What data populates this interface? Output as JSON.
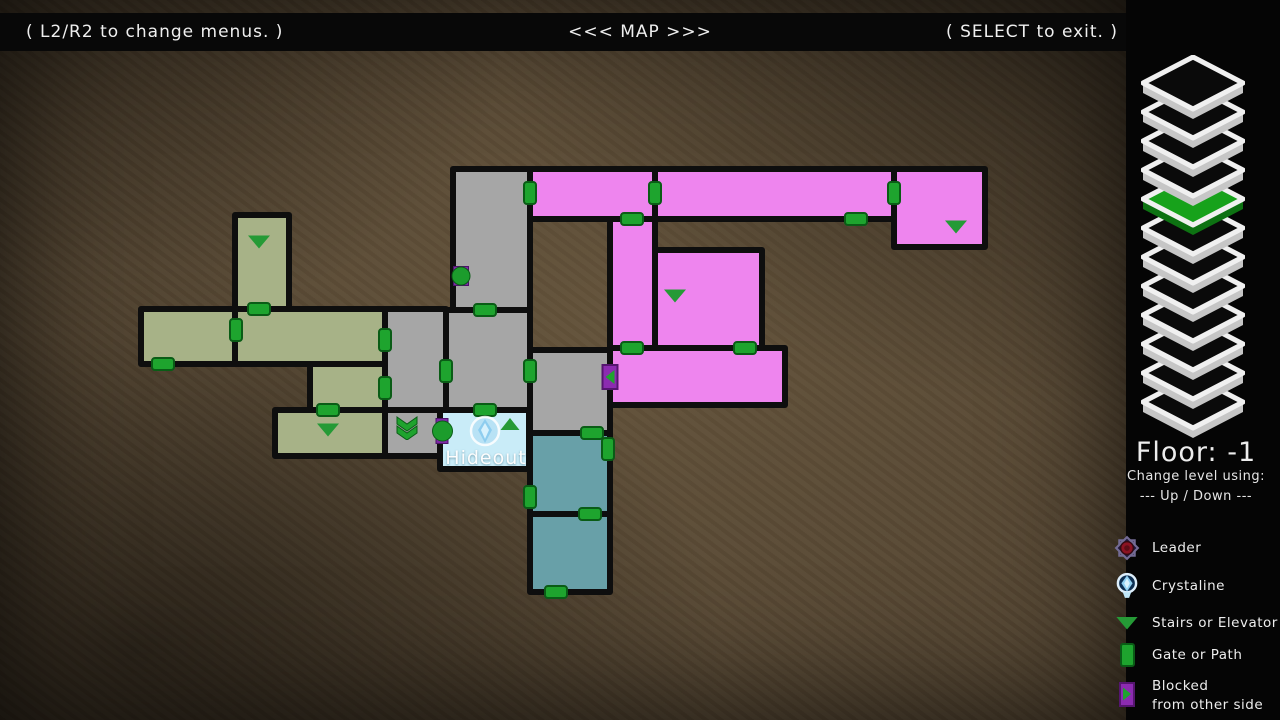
{
  "topbar": {
    "left": "( L2/R2 to change menus. )",
    "center": "<<< MAP >>>",
    "right": "( SELECT to exit. )"
  },
  "sidebar": {
    "floor_label": "Floor: -1",
    "change_hint_1": "Change level using:",
    "change_hint_2": "--- Up / Down ---",
    "floors": {
      "count": 12,
      "active_index": 4,
      "active_color": "#17a21b",
      "active_side": "#0d7212",
      "layer_color": "#0a0a0a",
      "layer_side": "#c6c6c6",
      "outline": "#f0f0f0"
    }
  },
  "legend": {
    "items": [
      {
        "id": "leader",
        "label": "Leader"
      },
      {
        "id": "crystaline",
        "label": "Crystaline"
      },
      {
        "id": "stairs",
        "label": "Stairs or Elevator"
      },
      {
        "id": "gate",
        "label": "Gate or Path"
      },
      {
        "id": "blocked",
        "label": "Blocked",
        "label2": "from other side"
      }
    ]
  },
  "map": {
    "palette": {
      "olive": "#a7b287",
      "gray": "#a6a6a6",
      "magenta": "#ee85ee",
      "teal": "#68a0a8",
      "hideout": "#c9ecf8"
    },
    "rooms": [
      {
        "id": "olive-tower",
        "x": 232,
        "y": 212,
        "w": 60,
        "h": 100,
        "color": "olive"
      },
      {
        "id": "olive-left",
        "x": 138,
        "y": 306,
        "w": 100,
        "h": 61,
        "color": "olive"
      },
      {
        "id": "olive-wide",
        "x": 232,
        "y": 306,
        "w": 156,
        "h": 61,
        "color": "olive"
      },
      {
        "id": "olive-mid",
        "x": 307,
        "y": 361,
        "w": 81,
        "h": 52,
        "color": "olive"
      },
      {
        "id": "olive-bottom",
        "x": 272,
        "y": 407,
        "w": 116,
        "h": 52,
        "color": "olive"
      },
      {
        "id": "gray-tall",
        "x": 450,
        "y": 166,
        "w": 83,
        "h": 147,
        "color": "gray"
      },
      {
        "id": "gray-west",
        "x": 382,
        "y": 306,
        "w": 67,
        "h": 107,
        "color": "gray"
      },
      {
        "id": "gray-mid",
        "x": 443,
        "y": 307,
        "w": 90,
        "h": 106,
        "color": "gray"
      },
      {
        "id": "gray-stairroom",
        "x": 382,
        "y": 407,
        "w": 61,
        "h": 52,
        "color": "gray"
      },
      {
        "id": "gray-east",
        "x": 527,
        "y": 347,
        "w": 86,
        "h": 89,
        "color": "gray"
      },
      {
        "id": "hideout-room",
        "x": 437,
        "y": 407,
        "w": 95,
        "h": 65,
        "color": "hideout"
      },
      {
        "id": "teal-upper",
        "x": 527,
        "y": 430,
        "w": 86,
        "h": 87,
        "color": "teal"
      },
      {
        "id": "teal-lower",
        "x": 527,
        "y": 511,
        "w": 86,
        "h": 84,
        "color": "teal"
      },
      {
        "id": "magenta-hall-w",
        "x": 527,
        "y": 166,
        "w": 131,
        "h": 56,
        "color": "magenta"
      },
      {
        "id": "magenta-hall-e",
        "x": 652,
        "y": 166,
        "w": 245,
        "h": 56,
        "color": "magenta"
      },
      {
        "id": "magenta-ne-room",
        "x": 891,
        "y": 166,
        "w": 97,
        "h": 84,
        "color": "magenta"
      },
      {
        "id": "magenta-shaft",
        "x": 607,
        "y": 216,
        "w": 51,
        "h": 135,
        "color": "magenta"
      },
      {
        "id": "magenta-square",
        "x": 652,
        "y": 247,
        "w": 113,
        "h": 104,
        "color": "magenta"
      },
      {
        "id": "magenta-big",
        "x": 607,
        "y": 345,
        "w": 181,
        "h": 63,
        "color": "magenta"
      }
    ],
    "doors": [
      {
        "x": 163,
        "y": 364,
        "o": "h"
      },
      {
        "x": 236,
        "y": 330,
        "o": "v"
      },
      {
        "x": 259,
        "y": 309,
        "o": "h"
      },
      {
        "x": 385,
        "y": 340,
        "o": "v"
      },
      {
        "x": 385,
        "y": 388,
        "o": "v"
      },
      {
        "x": 328,
        "y": 410,
        "o": "h"
      },
      {
        "x": 530,
        "y": 193,
        "o": "v"
      },
      {
        "x": 485,
        "y": 310,
        "o": "h"
      },
      {
        "x": 446,
        "y": 371,
        "o": "v"
      },
      {
        "x": 485,
        "y": 410,
        "o": "h"
      },
      {
        "x": 530,
        "y": 371,
        "o": "v"
      },
      {
        "x": 592,
        "y": 433,
        "o": "h"
      },
      {
        "x": 608,
        "y": 449,
        "o": "v"
      },
      {
        "x": 530,
        "y": 497,
        "o": "v"
      },
      {
        "x": 590,
        "y": 514,
        "o": "h"
      },
      {
        "x": 556,
        "y": 592,
        "o": "h"
      },
      {
        "x": 632,
        "y": 219,
        "o": "h"
      },
      {
        "x": 655,
        "y": 193,
        "o": "v"
      },
      {
        "x": 856,
        "y": 219,
        "o": "h"
      },
      {
        "x": 894,
        "y": 193,
        "o": "v"
      },
      {
        "x": 632,
        "y": 348,
        "o": "h"
      },
      {
        "x": 745,
        "y": 348,
        "o": "h"
      }
    ],
    "stairs": [
      {
        "x": 259,
        "y": 242,
        "dir": "down"
      },
      {
        "x": 328,
        "y": 430,
        "dir": "down"
      },
      {
        "x": 675,
        "y": 296,
        "dir": "down"
      },
      {
        "x": 956,
        "y": 227,
        "dir": "down"
      },
      {
        "x": 510,
        "y": 424,
        "dir": "up"
      },
      {
        "x": 407,
        "y": 429,
        "dir": "double_down"
      }
    ],
    "blocked": [
      {
        "x": 610,
        "y": 377,
        "dir": "left"
      }
    ],
    "circle_markers": [
      {
        "x": 461,
        "y": 276,
        "rw": 16,
        "rh": 20,
        "d": 19
      },
      {
        "x": 442,
        "y": 431,
        "rw": 13,
        "rh": 26,
        "d": 21
      }
    ],
    "hideout": {
      "label": "Hideout",
      "label_x": 486,
      "label_y": 458,
      "icon_x": 485,
      "icon_y": 433
    }
  }
}
